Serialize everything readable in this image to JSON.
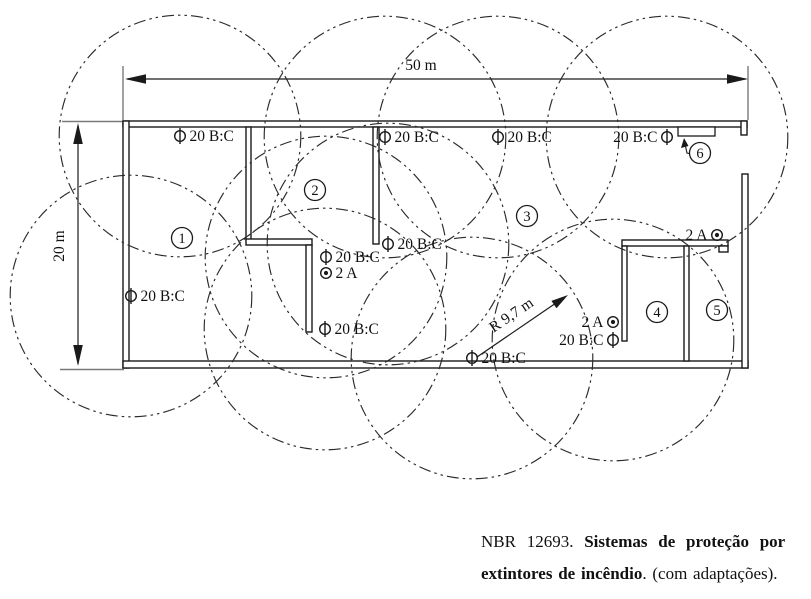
{
  "plan": {
    "px_per_m": 12.45,
    "coverage_radius_m": 9.7,
    "width_label": "50 m",
    "height_label": "20 m",
    "radius_label": "R 9,7 m"
  },
  "symbols": {
    "bc_rating_label": "20 B:C",
    "a_rating_label": "2 A"
  },
  "rooms": [
    {
      "number": "1",
      "x": 182,
      "y": 238
    },
    {
      "number": "2",
      "x": 315,
      "y": 190
    },
    {
      "number": "3",
      "x": 527,
      "y": 216
    },
    {
      "number": "4",
      "x": 657,
      "y": 312
    },
    {
      "number": "5",
      "x": 717,
      "y": 310
    },
    {
      "number": "6",
      "x": 700,
      "y": 153
    }
  ],
  "extinguishers": [
    {
      "type": "20BC",
      "label": "20 B:C",
      "x": 180,
      "y": 136,
      "label_side": "right",
      "coverage": true
    },
    {
      "type": "20BC",
      "label": "20 B:C",
      "x": 385,
      "y": 137,
      "label_side": "right",
      "coverage": true
    },
    {
      "type": "20BC",
      "label": "20 B:C",
      "x": 498,
      "y": 137,
      "label_side": "right",
      "coverage": true
    },
    {
      "type": "20BC",
      "label": "20 B:C",
      "x": 667,
      "y": 137,
      "label_side": "left",
      "coverage": true
    },
    {
      "type": "20BC",
      "label": "20 B:C",
      "x": 131,
      "y": 296,
      "label_side": "right",
      "coverage": true
    },
    {
      "type": "20BC",
      "label": "20 B:C",
      "x": 388,
      "y": 244,
      "label_side": "right",
      "coverage": true
    },
    {
      "type": "20BC",
      "label": "20 B:C",
      "x": 326,
      "y": 257,
      "label_side": "right",
      "coverage": true
    },
    {
      "type": "2A",
      "label": "2 A",
      "x": 326,
      "y": 273,
      "label_side": "right",
      "coverage": false
    },
    {
      "type": "20BC",
      "label": "20 B:C",
      "x": 325,
      "y": 329,
      "label_side": "right",
      "coverage": true
    },
    {
      "type": "20BC",
      "label": "20 B:C",
      "x": 472,
      "y": 358,
      "label_side": "right",
      "coverage": true
    },
    {
      "type": "2A",
      "label": "2 A",
      "x": 613,
      "y": 322,
      "label_side": "left",
      "coverage": false
    },
    {
      "type": "20BC",
      "label": "20 B:C",
      "x": 613,
      "y": 340,
      "label_side": "left",
      "coverage": true
    },
    {
      "type": "2A",
      "label": "2 A",
      "x": 717,
      "y": 235,
      "label_side": "left",
      "coverage": false
    }
  ],
  "caption": {
    "line1_regular": "NBR 12693. ",
    "line1_bold": "Sistemas de proteção por",
    "line2_bold": "extintores de incêndio",
    "line2_regular": ". (com adaptações)."
  }
}
